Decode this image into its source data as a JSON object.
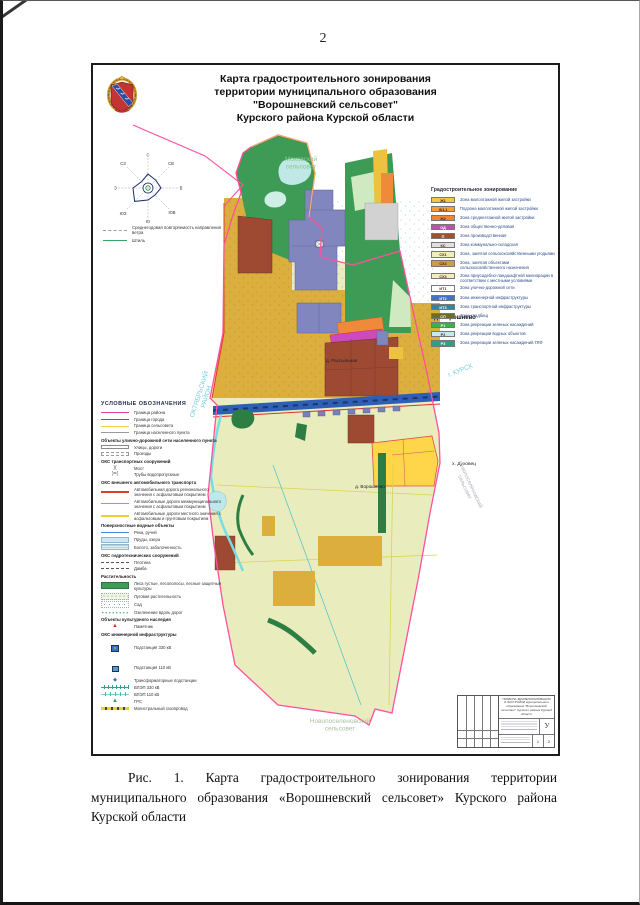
{
  "page": {
    "number": "2"
  },
  "figure": {
    "title_lines": [
      "Карта градостроительного зонирования",
      "территории муниципального образования",
      "\"Ворошневский сельсовет\"",
      "Курского района Курской области"
    ],
    "coat_of_arms": "герб Курской области",
    "wind_rose": {
      "directions": [
        "С",
        "СВ",
        "В",
        "ЮВ",
        "Ю",
        "ЮЗ",
        "З",
        "СЗ"
      ],
      "legend": [
        {
          "label": "Среднегодовая повторяемость направления ветра"
        },
        {
          "label": "Штиль"
        }
      ]
    },
    "map_labels": {
      "neighbor_top": "Моковский сельсовет",
      "settlement_voroshnevo": "д. Ворошнево",
      "settlement_voroshnevo_2": "д. Ворошнево",
      "settlement_rassylnaya": "д. Рассыльная",
      "settlement_dukhovets": "х. Духовец",
      "district_left": "ОКТЯБРЬСКИЙ РАЙОН",
      "city_right": "г. КУРСК",
      "neighbor_right": "Новопоселеновский сельсовет",
      "neighbor_bottom": "Новопоселеновский сельсовет"
    },
    "conventional_legend": {
      "title": "УСЛОВНЫЕ ОБОЗНАЧЕНИЯ",
      "groups": [
        {
          "title": "",
          "items": [
            {
              "swatch": "line-magenta",
              "label": "Граница района"
            },
            {
              "swatch": "line-red",
              "label": "Граница города"
            },
            {
              "swatch": "line-yellow",
              "label": "Граница сельсовета"
            },
            {
              "swatch": "line-grey",
              "label": "Граница населенного пункта"
            }
          ]
        },
        {
          "title": "Объекты улично-дорожной сети населенного пункта",
          "items": [
            {
              "swatch": "road",
              "label": "Улицы, дороги"
            },
            {
              "swatch": "road-dashed",
              "label": "Проезды"
            }
          ]
        },
        {
          "title": "ОКС транспортных сооружений",
          "items": [
            {
              "swatch": "bridge",
              "label": "Мост"
            },
            {
              "swatch": "culvert",
              "label": "Трубы водопропускные"
            }
          ]
        },
        {
          "title": "ОКС внешнего автомобильного транспорта",
          "items": [
            {
              "swatch": "line-red-thick",
              "label": "Автомобильная дорога регионального значения с асфальтовым покрытием"
            },
            {
              "swatch": "line-orange",
              "label": "Автомобильные дороги межмуниципального значения с асфальтовым покрытием"
            },
            {
              "swatch": "line-yellow-thick",
              "label": "Автомобильные дороги местного значения с асфальтовым и грунтовым покрытием"
            }
          ]
        },
        {
          "title": "Поверхностные водные объекты",
          "items": [
            {
              "swatch": "line-blue",
              "label": "Река, ручей"
            },
            {
              "swatch": "fill-lightblue",
              "label": "Пруды, озера"
            },
            {
              "swatch": "fill-swamp",
              "label": "Болото, заболоченность"
            }
          ]
        },
        {
          "title": "ОКС гидротехнических сооружений",
          "items": [
            {
              "swatch": "dash-dark",
              "label": "Плотина"
            },
            {
              "swatch": "dash-dark",
              "label": "Дамба"
            }
          ]
        },
        {
          "title": "Растительность",
          "items": [
            {
              "swatch": "fill-forest",
              "label": "Леса густые, лесополосы, лесные защитные культуры"
            },
            {
              "swatch": "dots-green",
              "label": "Луговая растительность"
            },
            {
              "swatch": "dots-sad",
              "label": "Сад"
            },
            {
              "swatch": "dots-road",
              "label": "Озеленение вдоль дорог"
            }
          ]
        },
        {
          "title": "Объекты культурного наследия",
          "items": [
            {
              "swatch": "monument",
              "label": "Памятник"
            }
          ]
        },
        {
          "title": "ОКС инженерной инфраструктуры",
          "items": [
            {
              "swatch": "sub330",
              "label": "Подстанция 330 кВ"
            },
            {
              "swatch": "sub110",
              "label": "Подстанция 110 кВ"
            },
            {
              "swatch": "transformer",
              "label": "Трансформаторные подстанции"
            },
            {
              "swatch": "vl330",
              "label": "ВЛЭП 330 кВ"
            },
            {
              "swatch": "vl110",
              "label": "ВЛЭП 110 кВ"
            },
            {
              "swatch": "grs",
              "label": "ГРС"
            },
            {
              "swatch": "gas",
              "label": "Магистральный газопровод"
            }
          ]
        }
      ]
    },
    "zoning_legend": {
      "title": "Градостроительное зонирование",
      "items": [
        {
          "code": "Ж1",
          "color": "#f0c93f",
          "label": "Зона малоэтажной жилой застройки"
        },
        {
          "code": "Ж1.1",
          "color": "#f0a03c",
          "label": "Подзона малоэтажной жилой застройки"
        },
        {
          "code": "Ж2",
          "color": "#ef8435",
          "label": "Зона среднеэтажной жилой застройки"
        },
        {
          "code": "ОД",
          "color": "#bf4fb4",
          "label": "Зона общественно-деловая"
        },
        {
          "code": "П",
          "color": "#a0522d",
          "label": "Зона производственная"
        },
        {
          "code": "КС",
          "color": "#e0e0e0",
          "label": "Зона коммунально-складская"
        },
        {
          "code": "СХ1",
          "color": "#eef0b8",
          "label": "Зона, занятая сельскохозяйственными угодьями"
        },
        {
          "code": "СХ2",
          "color": "#c7a13b",
          "label": "Зона, занятая объектами сельскохозяйственного назначения"
        },
        {
          "code": "СХ3",
          "color": "#f2ecc0",
          "label": "Зона приусадебно-ландшафтной мелиорации в соответствии с местными условиями"
        },
        {
          "code": "ИТ1",
          "color": "#ffffff",
          "label": "Зона улично-дорожной сети"
        },
        {
          "code": "ИТ2",
          "color": "#4472c4",
          "label": "Зона инженерной инфраструктуры"
        },
        {
          "code": "ИТ3",
          "color": "#2e86a0",
          "label": "Зона транспортной инфраструктуры"
        },
        {
          "code": "СП",
          "color": "#6e6e20",
          "label": "Зона кладбищ"
        },
        {
          "code": "Р1",
          "color": "#3fae4e",
          "label": "Зона рекреации зеленых насаждений"
        },
        {
          "code": "Р2",
          "color": "#c2ecf0",
          "label": "Зона рекреации водных объектов"
        },
        {
          "code": "Р3",
          "color": "#2fa083",
          "label": "Зона рекреации зеленых насаждений ГЛФ"
        }
      ]
    },
    "stamp": {
      "title": "ПРАВИЛА ЗЕМЛЕПОЛЬЗОВАНИЯ И ЗАСТРОЙКИ муниципального образования \"Ворошневский сельсовет\" Курского района Курской области",
      "letter": "У",
      "sheet": "1",
      "sheets": "2"
    }
  },
  "caption": "Рис. 1. Карта градостроительного зонирования территории муниципального образования «Ворошневский сельсовет» Курского района Курской области"
}
